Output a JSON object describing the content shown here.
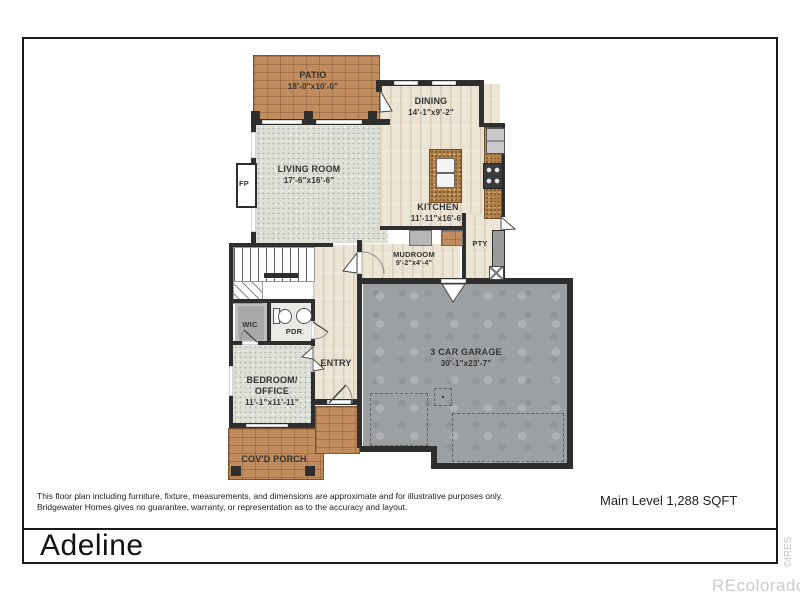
{
  "header": {
    "title": "Adeline"
  },
  "footer": {
    "disclaimer_line1": "This floor plan including furniture, fixture, measurements, and dimensions are approximate and for illustrative purposes only.",
    "disclaimer_line2": "Bridgewater Homes gives no guarantee, warranty, or representation as to the accuracy and layout.",
    "level_label": "Main Level 1,288 SQFT"
  },
  "watermarks": {
    "vertical": "©IRES",
    "brand": "REcolorado"
  },
  "rooms": {
    "patio": {
      "name": "PATIO",
      "dims": "18'-0\"x10'-0\""
    },
    "dining": {
      "name": "DINING",
      "dims": "14'-1\"x9'-2\""
    },
    "living": {
      "name": "LIVING ROOM",
      "dims": "17'-6\"x16'-6\""
    },
    "kitchen": {
      "name": "KITCHEN",
      "dims": "11'-11\"x16'-6\""
    },
    "mudroom": {
      "name": "MUDROOM",
      "dims": "9'-2\"x4'-4\""
    },
    "pantry": {
      "name": "PTY"
    },
    "garage": {
      "name": "3 CAR GARAGE",
      "dims": "30'-1\"x23'-7\""
    },
    "wic": {
      "name": "WIC"
    },
    "powder": {
      "name": "PDR"
    },
    "entry": {
      "name": "ENTRY"
    },
    "bedroom": {
      "name": "BEDROOM/\nOFFICE",
      "dims": "11'-1\"x11'-11\""
    },
    "porch": {
      "name": "COV'D PORCH"
    },
    "fireplace": {
      "name": "FP"
    }
  },
  "colors": {
    "wall": "#2e2e2e",
    "tile": "#c18d5e",
    "carpet": "#dde0d7",
    "wood": "#ece4d4",
    "garage_floor": "#9da0a3",
    "granite": "#b08049"
  }
}
